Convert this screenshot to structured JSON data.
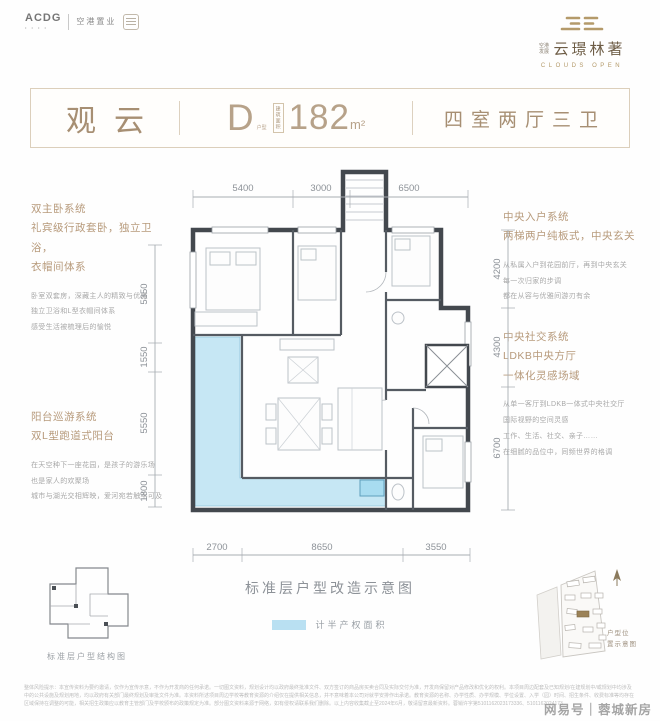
{
  "colors": {
    "accent": "#a78f73",
    "gold": "#b49a6a",
    "balcony_fill": "#c6e7f4",
    "wall": "#43484e",
    "dim_text": "#8d9298",
    "legend_swatch": "#b9e0f2"
  },
  "logos": {
    "acdg": "ACDG",
    "company": "空港置业",
    "brand_prefix_line1": "空港",
    "brand_prefix_line2": "发展",
    "brand": "云璟林著",
    "brand_en": "CLOUDS OPEN"
  },
  "header": {
    "unit_name": "观云",
    "type_letter": "D",
    "type_label": "户型",
    "area_label": "建筑面积",
    "area_value": "182",
    "area_unit": "m²",
    "layout": "四室两厅三卫"
  },
  "features": {
    "left": [
      {
        "title": [
          "双主卧系统",
          "礼宾级行政套卧，独立卫浴，",
          "衣帽间体系"
        ],
        "body": [
          "卧室双套房，深藏主人的精致与优雅",
          "独立卫浴和L型衣帽间体系",
          "感受生活被梳理后的愉悦"
        ]
      },
      {
        "title": [
          "阳台巡游系统",
          "双L型跑道式阳台"
        ],
        "body": [
          "在天空种下一座花园，是孩子的游乐场",
          "也是家人的欢聚场",
          "城市与湖光交相辉映，爱河宛若触手可及"
        ]
      }
    ],
    "right": [
      {
        "title": [
          "中央入户系统",
          "两梯两户纯板式，中央玄关"
        ],
        "body": [
          "从私属入户到花园前厅，再到中央玄关",
          "每一次归家的步调",
          "都在从容与优雅间游刃有余"
        ]
      },
      {
        "title": [
          "中央社交系统",
          "LDKB中央方厅",
          "一体化灵感场域"
        ],
        "body": [
          "从单一客厅到LDKB一体式中央社交厅",
          "国际视野的空间灵感",
          "工作、生活、社交、亲子……",
          "在细腻的品位中，同频世界的格调"
        ]
      }
    ]
  },
  "plan": {
    "dims": {
      "top": [
        "5400",
        "3000",
        "6500"
      ],
      "left": [
        "5350",
        "1550",
        "5550",
        "1800"
      ],
      "right": [
        "4200",
        "4300",
        "6700"
      ],
      "bottom": [
        "2700",
        "8650",
        "3550"
      ]
    },
    "caption": "标准层户型改造示意图",
    "legend": "计半产权面积"
  },
  "minis": {
    "structure_caption": "标准层户型结构图",
    "site_caption_line1": "户型位",
    "site_caption_line2": "置示意图"
  },
  "disclaimer": {
    "line1": "整体风险提示：本宣传资料为要约邀请，仅作为宣传示意，不作为开发商的任何承诺。一切图文资料，规划设计均以政府最终批准文件、双方签订的商品房买卖合同及实际交付为准，开发商保留对产品修改和优化的权利。本项目周边配套及已知规划/在建规划中/或规划中均涉及",
    "line2": "中的公共设施及规划用地，均以政府有关部门最终规划及审批文件为准。本资料所述项目周边学校等教育资源的介绍仅在提供相关信息，并不意味着本公司对就学安排作出承诺。教育资源的名称、办学性质、办学规模、学位设置、入学（园）时间、招生条件、收费标准等均存在",
    "line3": "区域保持在调整的可能，相关招生政策应以教育主管部门及学校颁布的政策规定为准。部分图文资料来源于网络，如有侵权请联系我们删除。以上内容收集截止至2024年6月，敬请留意最新资料。蓉销许字第5101162023173336、5101162024173"
  },
  "watermark": "网易号｜蓉城新房"
}
